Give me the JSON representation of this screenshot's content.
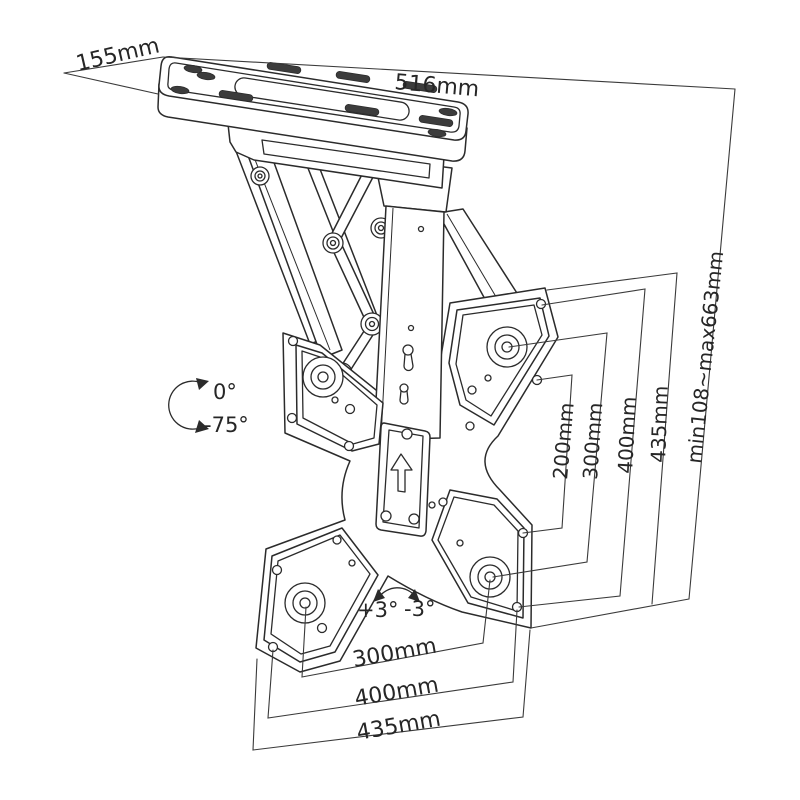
{
  "drawing": {
    "kind": "technical-dimension-drawing",
    "subject": "folding ceiling TV mount bracket",
    "background_color": "#ffffff",
    "ink_color": "#2b2b2b",
    "labels": {
      "plate_depth": "155mm",
      "plate_width": "516mm",
      "height_range": "min108~max663mm",
      "fold_angle_up": "0°",
      "fold_angle_down": "-75°",
      "swivel_left": "+3°",
      "swivel_right": "-3°",
      "vesa_vertical_200": "200mm",
      "vesa_vertical_300": "300mm",
      "vesa_vertical_400": "400mm",
      "vesa_vertical_435": "435mm",
      "vesa_horizontal_300": "300mm",
      "vesa_horizontal_400": "400mm",
      "vesa_horizontal_435": "435mm"
    },
    "icons": {
      "orientation_arrow": "up-arrow",
      "fold_range_arrow": "curved-double-arrow",
      "swivel_range_arrow": "curved-double-arrow"
    }
  }
}
